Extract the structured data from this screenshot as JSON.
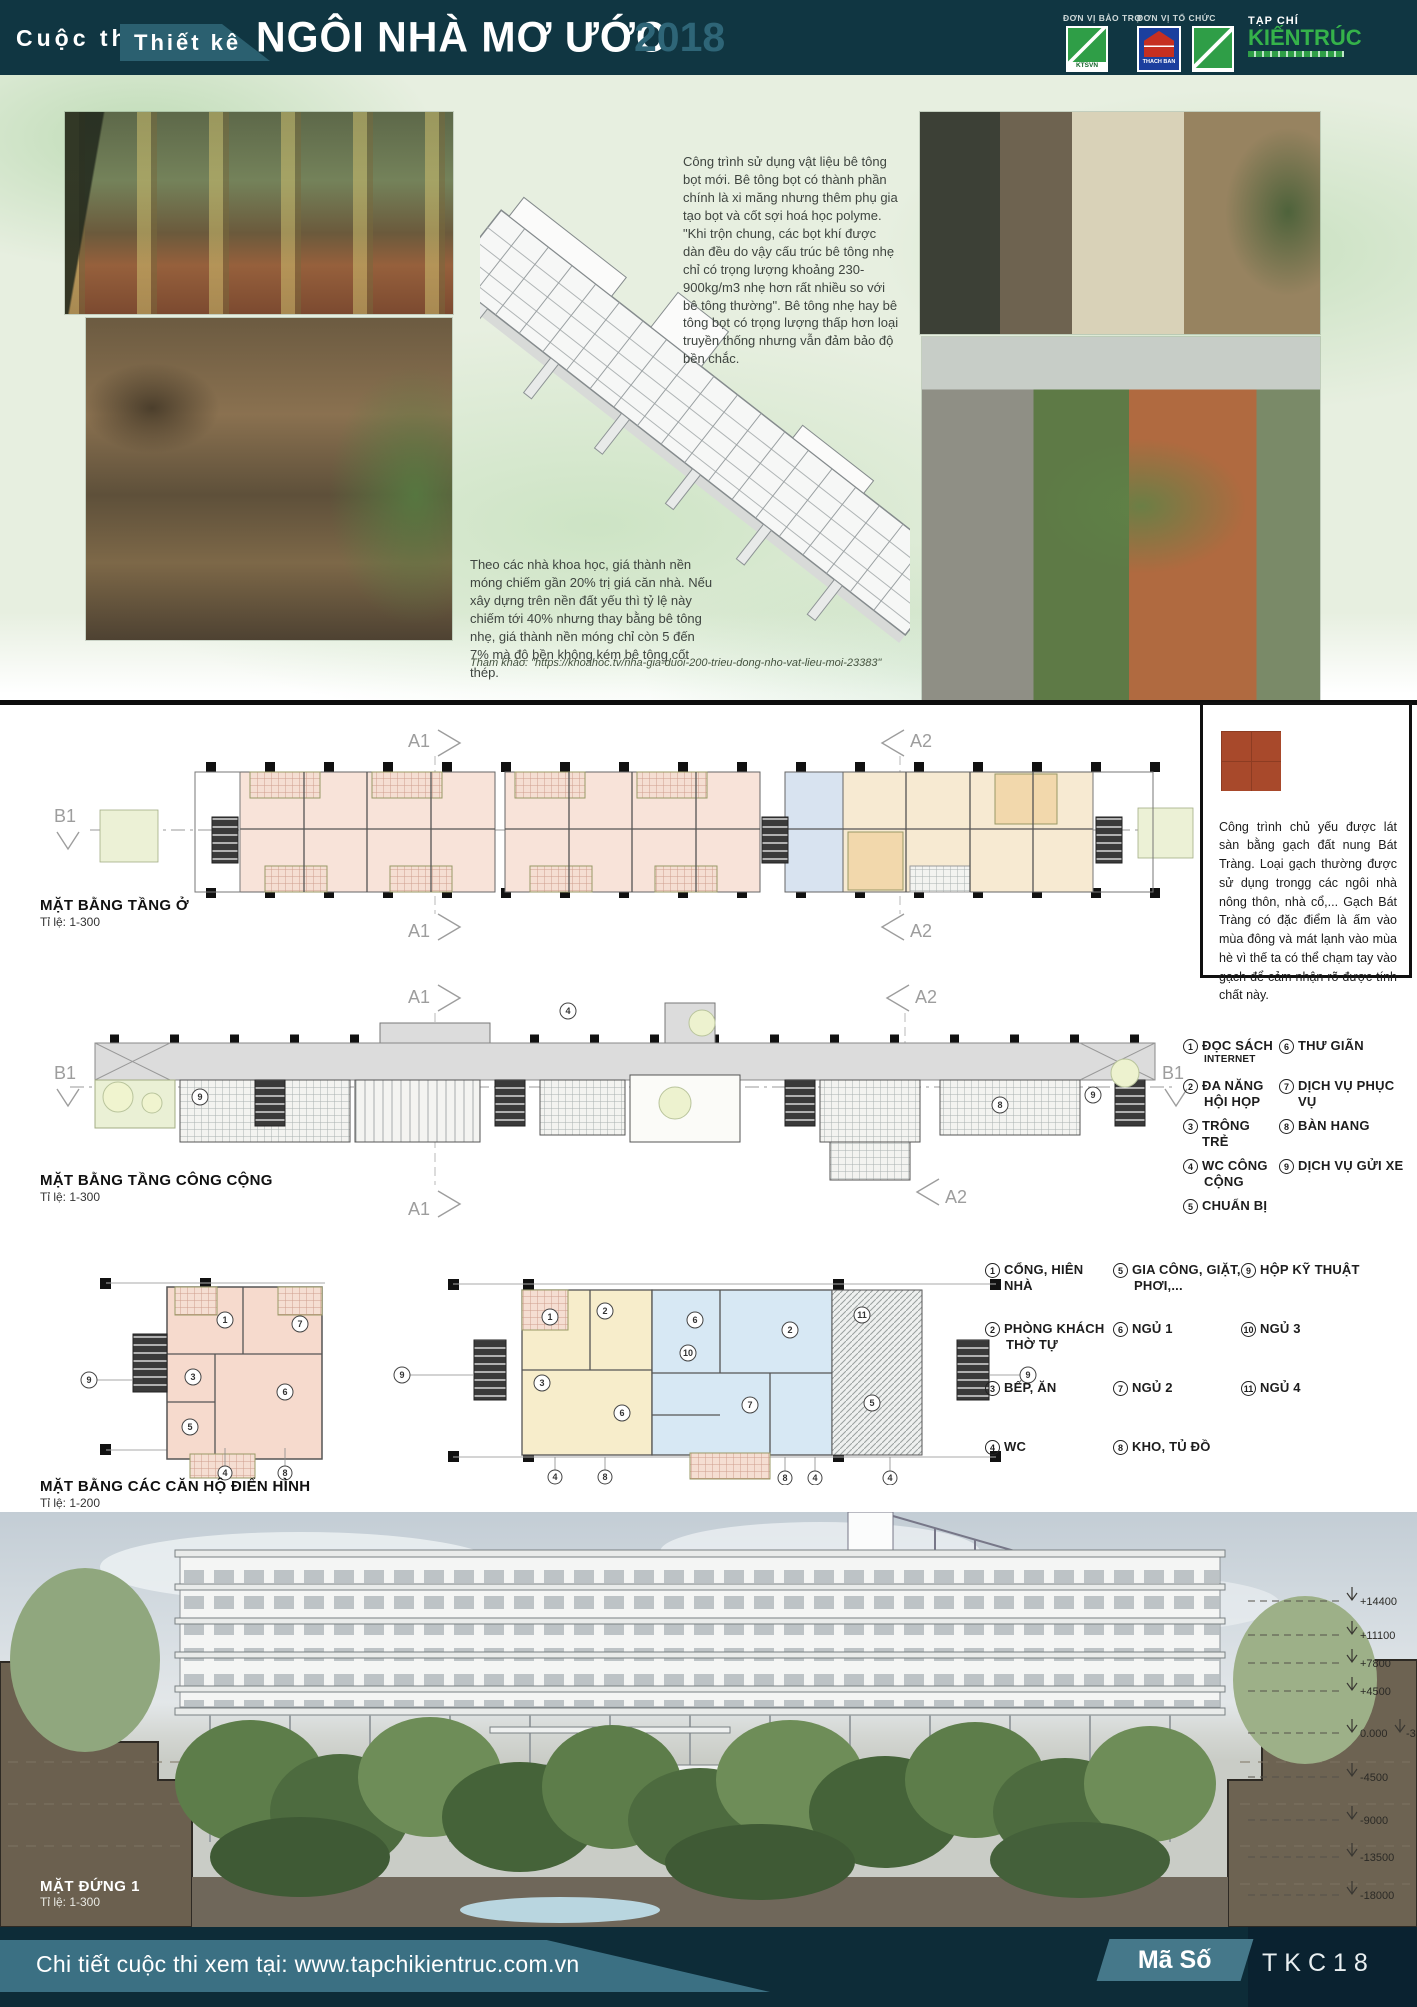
{
  "header": {
    "contest": "Cuộc thi",
    "design": "Thiết kế",
    "title": "NGÔI NHÀ MƠ ƯỚC",
    "year": "2018",
    "sponsor_label": "ĐƠN VỊ BẢO TRỢ",
    "organizer_label": "ĐƠN VỊ TỔ CHỨC",
    "logo_ktsvn": "KTSVN",
    "logo_thachban": "THACH BAN",
    "magazine_prefix": "TẠP CHÍ",
    "magazine_name": "KIẾNTRÚC"
  },
  "intro": {
    "concrete_text": "Công trình sử dụng vật liệu bê tông bọt mới. Bê tông bọt có thành phần chính là xi măng nhưng thêm phụ gia tạo bọt và cốt sợi hoá học polyme. \"Khi trộn chung, các bọt khí được dàn đều do vậy cấu trúc bê tông nhẹ chỉ có trọng lượng khoảng 230- 900kg/m3 nhẹ hơn rất nhiều so với bê tông thường\". Bê tông nhẹ hay bê tông bọt có trọng lượng thấp hơn loại truyền thống nhưng vẫn đảm bảo độ bền chắc.",
    "foundation_text": "Theo các nhà khoa học, giá thành nền móng chiếm gần 20% trị giá căn nhà. Nếu xây dựng trên nền đất yếu thì tỷ lệ này chiếm tới 40% nhưng thay bằng bê tông nhẹ, giá thành nền móng chỉ còn 5 đến 7% mà độ bền không kém bê tông cốt thép.",
    "reference": "Tham khảo: \"https://khoahoc.tv/nha-gia-duoi-200-trieu-dong-nho-vat-lieu-moi-23383\""
  },
  "brick_note": "Công trình chủ yếu được lát sàn bằng gạch đất nung Bát Tràng. Loại gạch thường được sử dụng trongg các ngôi nhà nông thôn, nhà cổ,... Gạch Bát Tràng có đặc điểm là ấm vào mùa đông và mát lạnh vào mùa hè vì thế ta có thể chạm tay vào gạch để cảm nhận rõ được tính chất này.",
  "grid": {
    "a1": "A1",
    "a2": "A2",
    "b1": "B1"
  },
  "plan_residential": {
    "title": "MẶT BẰNG TẦNG Ở",
    "scale": "Tỉ lệ: 1-300"
  },
  "plan_public": {
    "title": "MẶT BẰNG TẦNG CÔNG CỘNG",
    "scale": "Tỉ lệ: 1-300"
  },
  "plan_apartments": {
    "title": "MẶT BẰNG CÁC CĂN HỘ ĐIỂN HÌNH",
    "scale": "Tỉ lệ: 1-200"
  },
  "elevation": {
    "title": "MẶT ĐỨNG 1",
    "scale": "Tỉ lệ: 1-300",
    "levels": [
      "+14400",
      "+11100",
      "+7800",
      "+4500",
      "0.000",
      "-4500",
      "-9000",
      "-13500",
      "-18000"
    ],
    "level_zero_offset": "-30"
  },
  "legend_public": {
    "items": [
      {
        "n": "1",
        "t": "ĐỌC SÁCH",
        "t2": "INTERNET"
      },
      {
        "n": "2",
        "t": "ĐA NĂNG",
        "t2": "HỘI HỌP"
      },
      {
        "n": "3",
        "t": "TRÔNG TRẺ",
        "t2": ""
      },
      {
        "n": "4",
        "t": "WC CÔNG",
        "t2": "CỘNG"
      },
      {
        "n": "5",
        "t": "CHUẨN BỊ",
        "t2": ""
      },
      {
        "n": "6",
        "t": "THƯ GIÃN",
        "t2": ""
      },
      {
        "n": "7",
        "t": "DỊCH VỤ PHỤC VỤ",
        "t2": ""
      },
      {
        "n": "8",
        "t": "BÀN HANG",
        "t2": ""
      },
      {
        "n": "9",
        "t": "DỊCH VỤ GỬI XE",
        "t2": ""
      }
    ]
  },
  "legend_apartment": {
    "items": [
      {
        "n": "1",
        "t": "CỔNG, HIÊN NHÀ",
        "t2": ""
      },
      {
        "n": "2",
        "t": "PHÒNG KHÁCH",
        "t2": "THỜ TỰ"
      },
      {
        "n": "3",
        "t": "BẾP, ĂN",
        "t2": ""
      },
      {
        "n": "4",
        "t": "WC",
        "t2": ""
      },
      {
        "n": "5",
        "t": "GIA CÔNG, GIẶT,",
        "t2": "PHƠI,..."
      },
      {
        "n": "6",
        "t": "NGỦ 1",
        "t2": ""
      },
      {
        "n": "7",
        "t": "NGỦ 2",
        "t2": ""
      },
      {
        "n": "8",
        "t": "KHO, TỦ ĐỒ",
        "t2": ""
      },
      {
        "n": "9",
        "t": "HỘP KỸ THUẬT",
        "t2": ""
      },
      {
        "n": "10",
        "t": "NGỦ 3",
        "t2": ""
      },
      {
        "n": "11",
        "t": "NGỦ 4",
        "t2": ""
      }
    ]
  },
  "markers": {
    "n1": "1",
    "n2": "2",
    "n3": "3",
    "n4": "4",
    "n5": "5",
    "n6": "6",
    "n7": "7",
    "n8": "8",
    "n9": "9",
    "n10": "10",
    "n11": "11"
  },
  "footer": {
    "details": "Chi tiết  cuộc thi xem tại: www.tapchikientruc.com.vn",
    "code_label": "Mã Số",
    "code_value": "TKC18"
  },
  "colors": {
    "teal_dark": "#103642",
    "teal_mid": "#3b7083",
    "accent_green": "#2f9e47",
    "tile_red": "#a8492b"
  }
}
